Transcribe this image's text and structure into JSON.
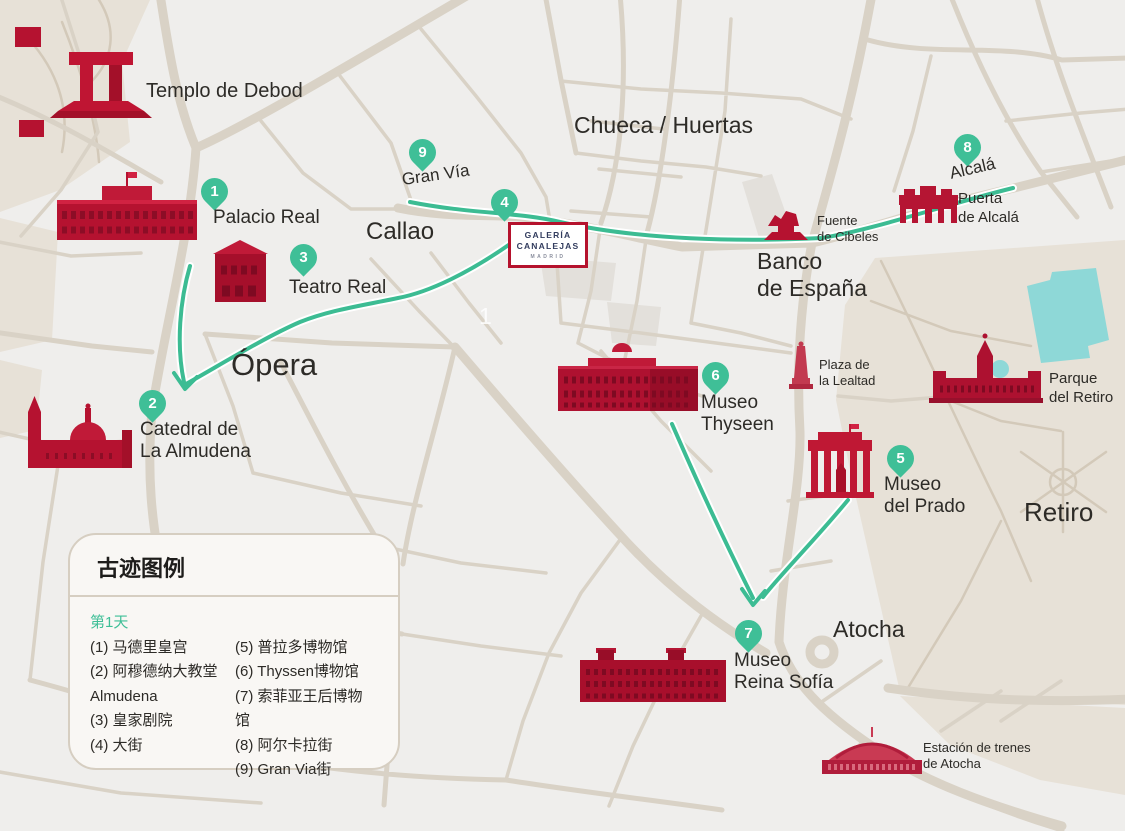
{
  "markers": [
    {
      "number": "1",
      "label": "Palacio Real"
    },
    {
      "number": "2",
      "label": "Catedral de\nLa Almudena"
    },
    {
      "number": "3",
      "label": "Teatro Real"
    },
    {
      "number": "4",
      "label": ""
    },
    {
      "number": "5",
      "label": "Museo\ndel Prado"
    },
    {
      "number": "6",
      "label": "Museo\nThyseen"
    },
    {
      "number": "7",
      "label": "Museo\nReina Sofía"
    },
    {
      "number": "8",
      "label": "Alcalá"
    },
    {
      "number": "9",
      "label": "Gran Vía"
    }
  ],
  "area_labels": {
    "templo_de_debod": "Templo de Debod",
    "chueca_huertas": "Chueca / Huertas",
    "callao": "Callao",
    "opera": "Ópera",
    "banco_de_espana": "Banco\nde España",
    "retiro": "Retiro",
    "atocha": "Atocha"
  },
  "poi_labels": {
    "fuente_de_cibeles": "Fuente\nde Cibeles",
    "puerta_de_alcala": "Puerta\nde Alcalá",
    "plaza_de_la_lealtad": "Plaza de\nla Lealtad",
    "parque_del_retiro": "Parque\ndel Retiro",
    "estacion_de_atocha": "Estación de trenes\nde Atocha"
  },
  "watermark": "1",
  "logo": {
    "line1": "GALERÍA",
    "line2": "CANALEJAS",
    "line3": "MADRID"
  },
  "legend": {
    "title": "古迹图例",
    "day": "第1天",
    "column1": [
      "(1) 马德里皇宫",
      "(2) 阿穆德纳大教堂",
      "Almudena",
      "(3) 皇家剧院",
      "(4) 大街"
    ],
    "column2": [
      "(5) 普拉多博物馆",
      "(6) Thyssen博物馆",
      "(7) 索菲亚王后博物",
      "馆",
      "(8) 阿尔卡拉街",
      "(9) Gran Via街"
    ]
  },
  "colors": {
    "route_green": "#3cbc93",
    "marker_green": "#3fbf97",
    "monument_red": "#b51230",
    "road_tan": "#d9d2c6",
    "park_beige": "#e7e1d7",
    "water_teal": "#8ed8d7",
    "background": "#efeeec",
    "logo_border_red": "#b5122d",
    "logo_text_navy": "#323c5e"
  }
}
